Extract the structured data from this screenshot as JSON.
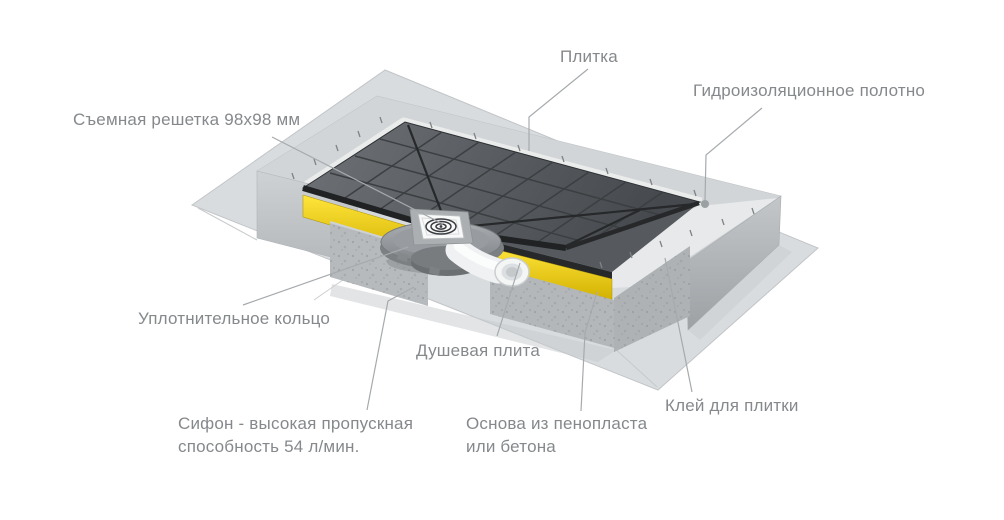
{
  "diagram": {
    "labels": {
      "grate": "Съемная решетка 98x98 мм",
      "tile": "Плитка",
      "membrane": "Гидроизоляционное полотно",
      "sealing_ring": "Уплотнительное кольцо",
      "shower_plate": "Душевая плита",
      "siphon": "Сифон - высокая пропускная способность 54 л/мин.",
      "base": "Основа из пенопласта или бетона",
      "tile_glue": "Клей для плитки"
    },
    "colors": {
      "background": "#ffffff",
      "label_text": "#85898c",
      "leader_line": "#a6aaad",
      "accent_yellow": "#f2ce00",
      "tile_surface": "#54585c",
      "concrete": "#c3c7ca",
      "membrane_sheet": "#d9dcde",
      "grate_white": "#f8f9f9"
    }
  }
}
